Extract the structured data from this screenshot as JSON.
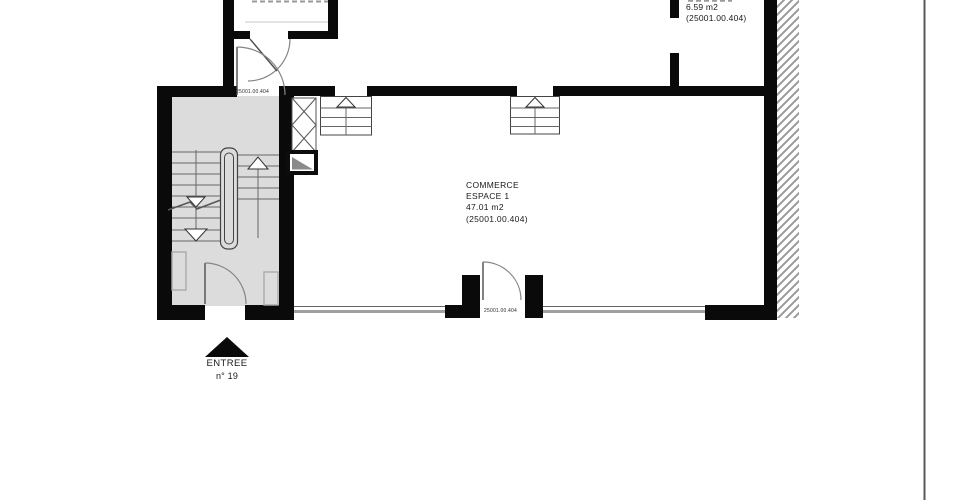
{
  "labels": {
    "commerce": {
      "line1": "COMMERCE",
      "line2": "ESPACE 1",
      "line3": "47.01 m2",
      "line4": "(25001.00.404)"
    },
    "room_top_right": {
      "line1": "6.59 m2",
      "line2": "(25001.00.404)"
    },
    "door_top": "25001.00.404",
    "door_bottom": "25001.00.404",
    "entrance": {
      "line1": "ENTREE",
      "line2": "n° 19"
    }
  },
  "colors": {
    "wall": "#0a0a0a",
    "stair_fill": "#dcdcdc",
    "hatch": "#9a9a9a",
    "line": "#555555",
    "arc": "#858585",
    "text": "#1a1a1a",
    "glass": "#a0a0a0",
    "faint": "#c9c9c9",
    "page_border": "#5a5a5a"
  }
}
